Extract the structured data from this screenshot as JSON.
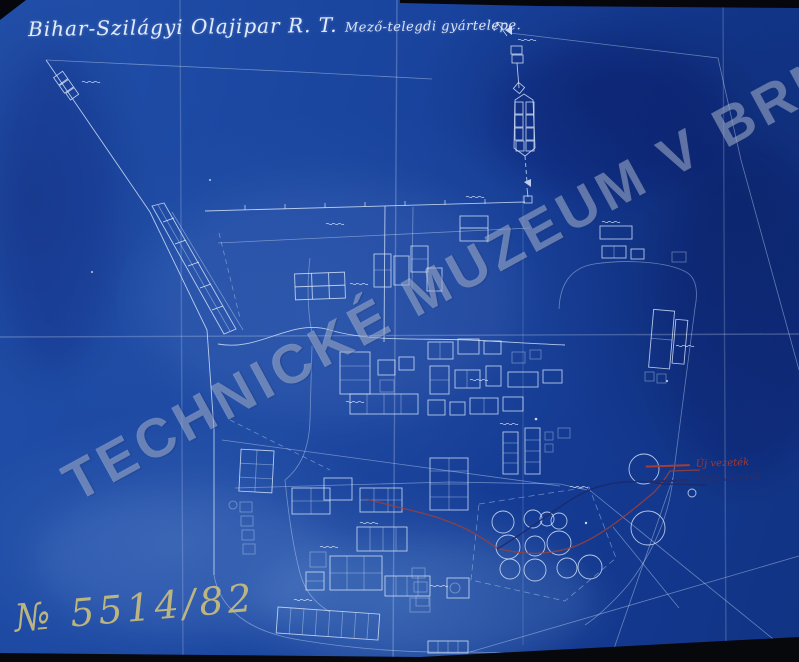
{
  "document": {
    "title_main": "Bihar-Szilágyi Olajipar R. T.",
    "title_sub": "Mező-telegdi gyártelepe.",
    "watermark": "TECHNICKÉ MUZEUM V BRNĚ",
    "archive_number": "№ 5514/82"
  },
  "legend": {
    "items": [
      {
        "label": "Új vezeték",
        "color": "#a63c34"
      },
      {
        "label": "Régi vezeték",
        "color": "#232e6e"
      }
    ]
  },
  "colors": {
    "paper_blue": "#16418f",
    "line_white": "#d8e6fb",
    "pipeline_new_red": "#a63c34",
    "pipeline_old_navy": "#232e6e",
    "archive_number_ink": "#c9bd7d",
    "watermark_grey": "#cdd9ea"
  }
}
